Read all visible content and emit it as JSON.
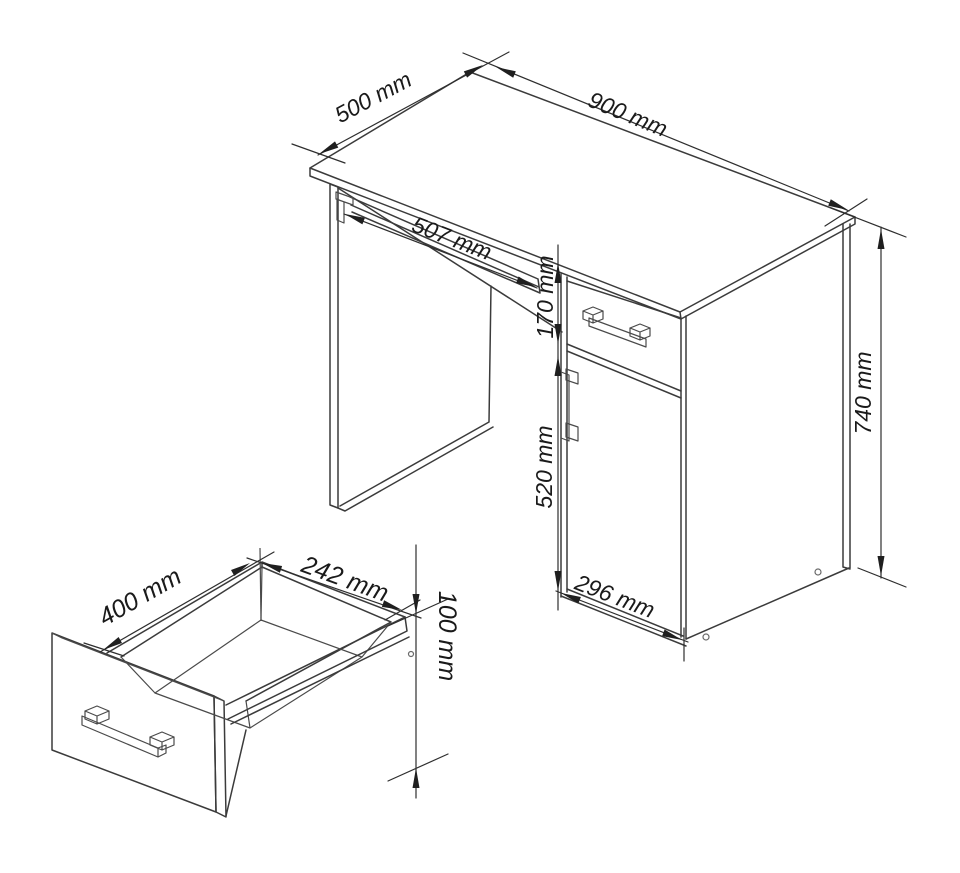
{
  "drawing": {
    "desk": {
      "depth_label": "500 mm",
      "width_label": "900 mm",
      "tray_width_label": "507 mm",
      "drawer_front_height_label": "170 mm",
      "door_height_label": "520 mm",
      "door_width_label": "296 mm",
      "total_height_label": "740 mm"
    },
    "drawer_detail": {
      "depth_label": "400 mm",
      "width_label": "242 mm",
      "height_label": "100 mm"
    }
  },
  "colors": {
    "background": "#ffffff",
    "line": "#3b3b3b",
    "dimension_line": "#2e2e2e",
    "text": "#1a1a1a"
  }
}
